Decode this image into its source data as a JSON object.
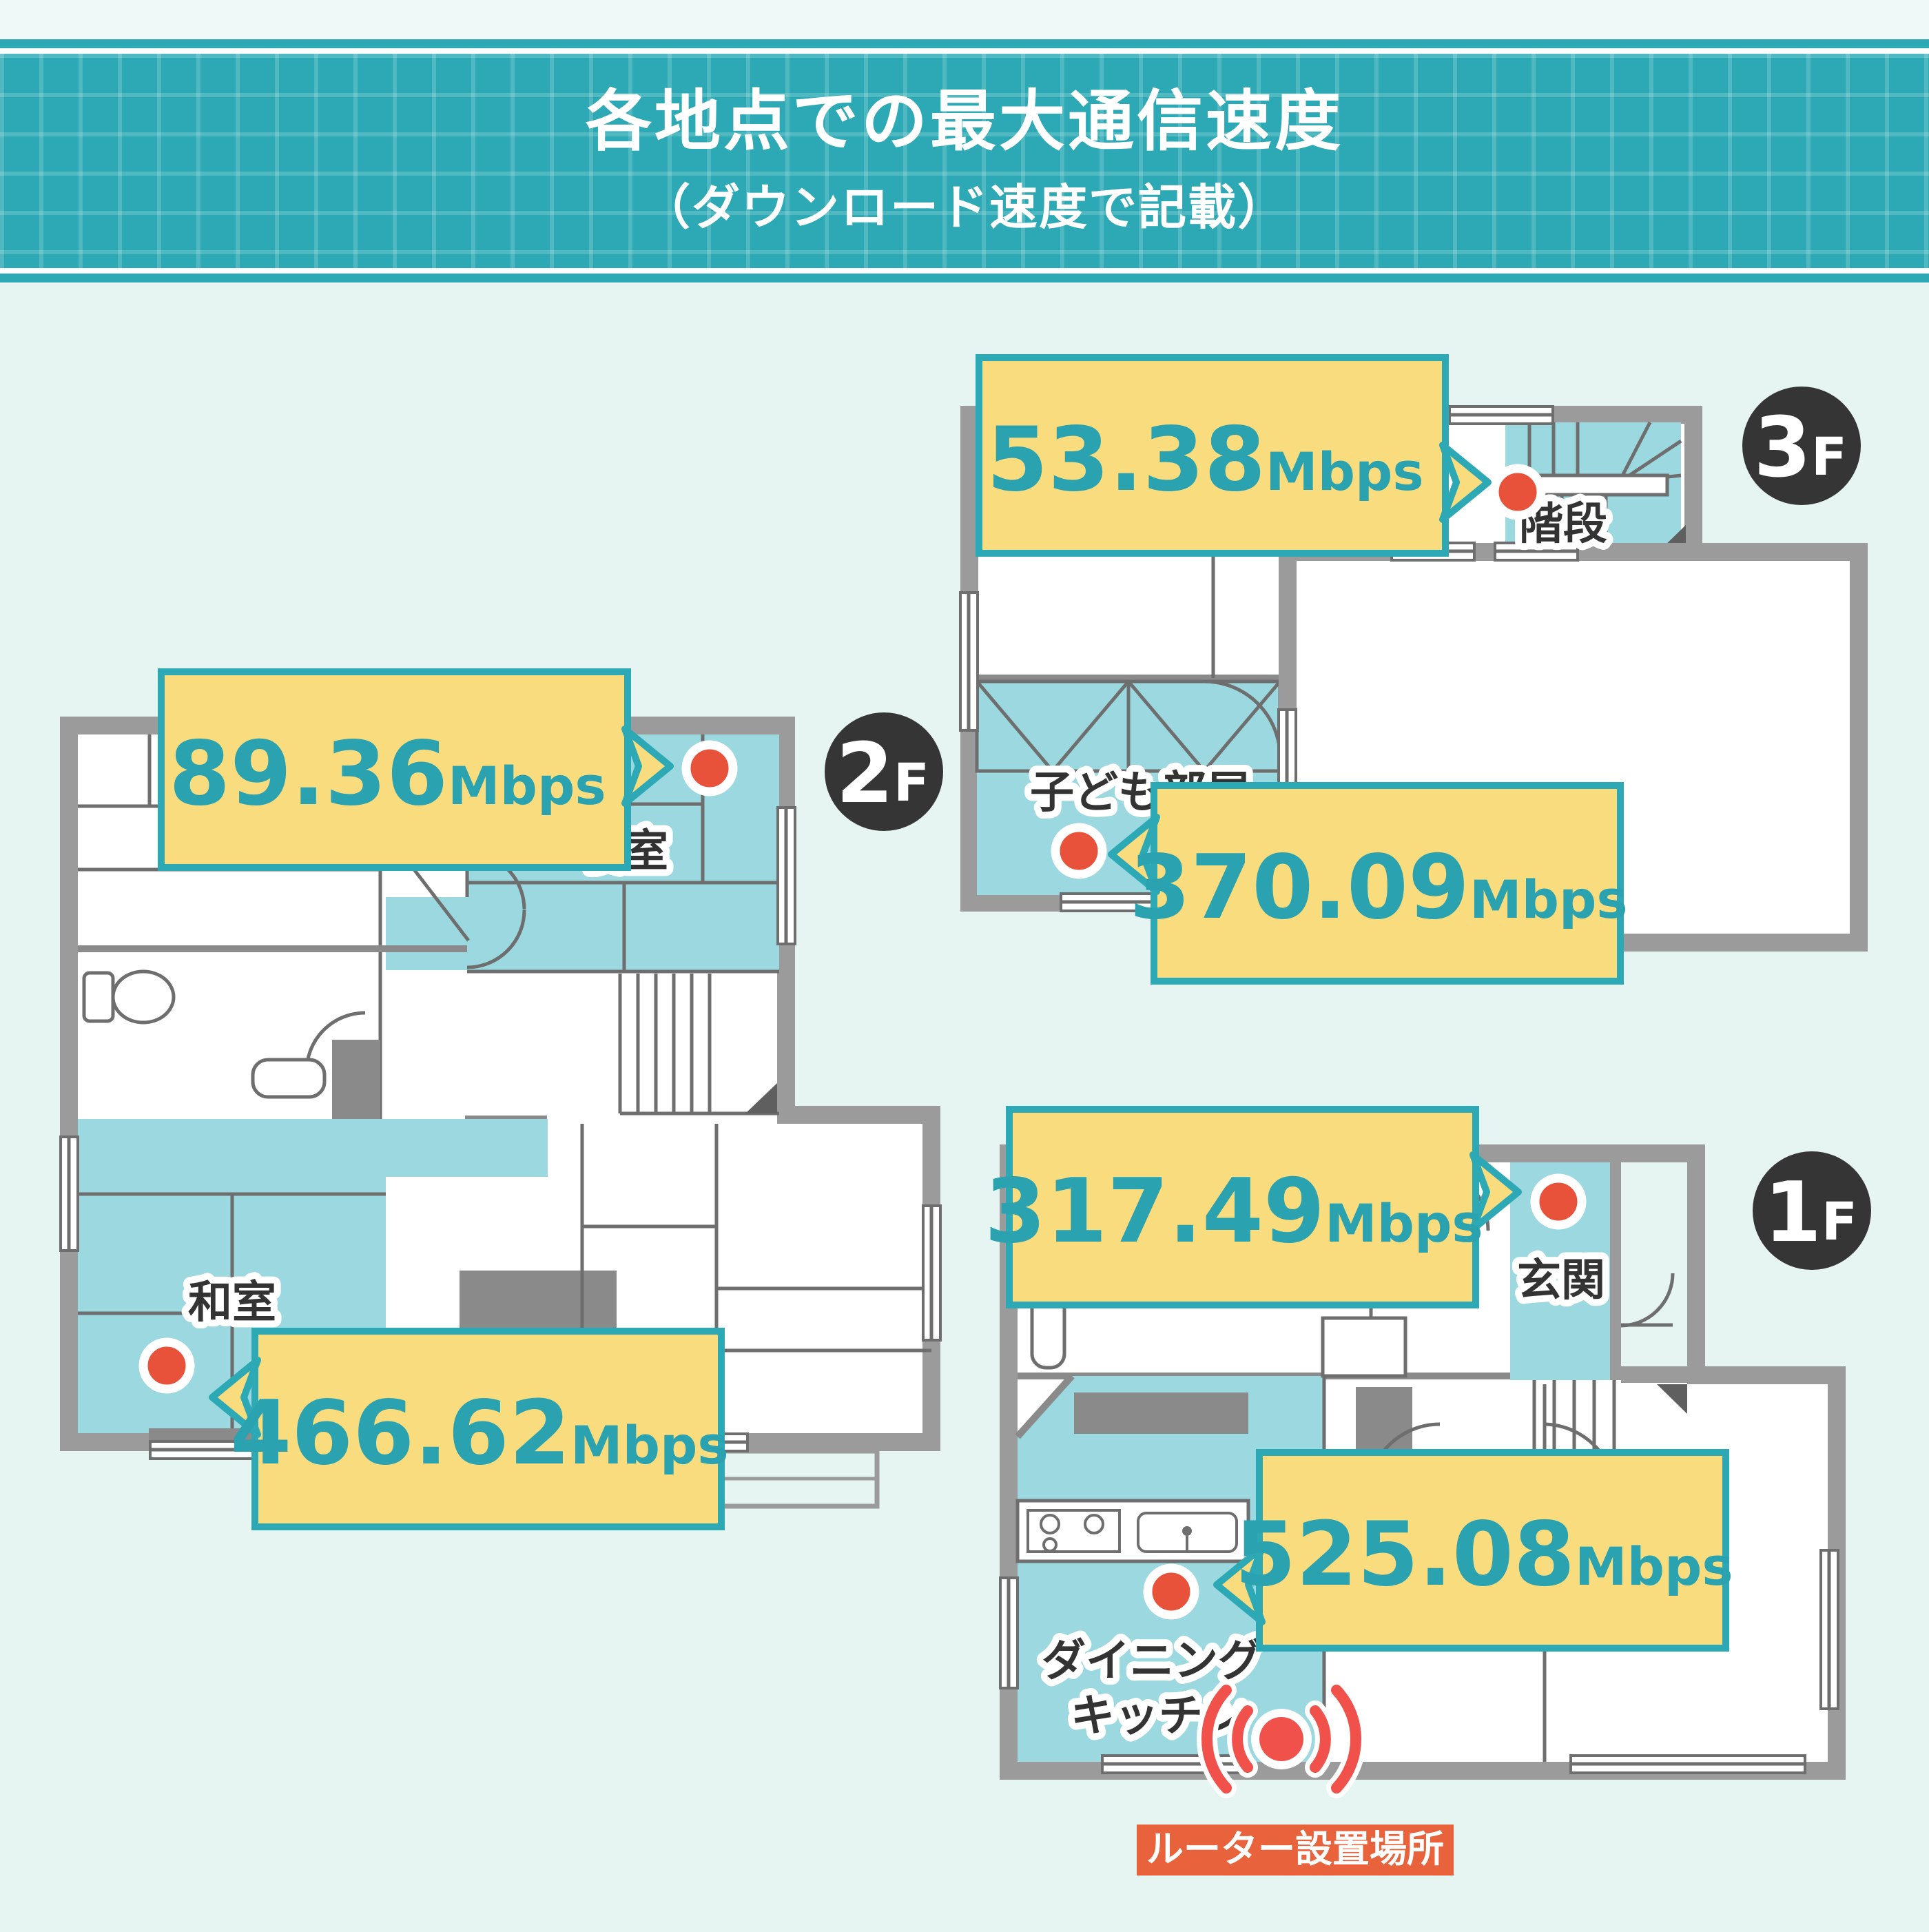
{
  "header": {
    "title": "各地点での最大通信速度",
    "subtitle": "（ダウンロード速度で記載）"
  },
  "floors": [
    {
      "badge": {
        "num": "3",
        "suffix": "F"
      },
      "measurements": [
        {
          "value": "53.38",
          "unit": "Mbps"
        },
        {
          "value": "370.09",
          "unit": "Mbps"
        }
      ],
      "rooms": {
        "stairs": "階段",
        "kids_room": "子ども部屋"
      }
    },
    {
      "badge": {
        "num": "2",
        "suffix": "F"
      },
      "measurements": [
        {
          "value": "89.36",
          "unit": "Mbps"
        },
        {
          "value": "466.62",
          "unit": "Mbps"
        }
      ],
      "rooms": {
        "bedroom": "寝室",
        "japanese_room": "和室"
      }
    },
    {
      "badge": {
        "num": "1",
        "suffix": "F"
      },
      "measurements": [
        {
          "value": "317.49",
          "unit": "Mbps"
        },
        {
          "value": "525.08",
          "unit": "Mbps"
        }
      ],
      "rooms": {
        "entrance": "玄関",
        "dining_line1": "ダイニング",
        "dining_line2": "キッチン"
      }
    }
  ],
  "router": {
    "label": "ルーター設置場所"
  },
  "icons": {
    "router": "wifi-signal-icon",
    "measurement_point": "dot-icon"
  },
  "colors": {
    "accent_teal": "#2CA9B5",
    "bubble_yellow": "#F9DC7D",
    "room_teal": "#9BD8DF",
    "wall_gray": "#9B9B9B",
    "dot_red": "#E8523A",
    "router_red": "#F0514B",
    "router_label_bg": "#E8623C",
    "badge_dark": "#353535",
    "background": "#E6F4F2"
  }
}
